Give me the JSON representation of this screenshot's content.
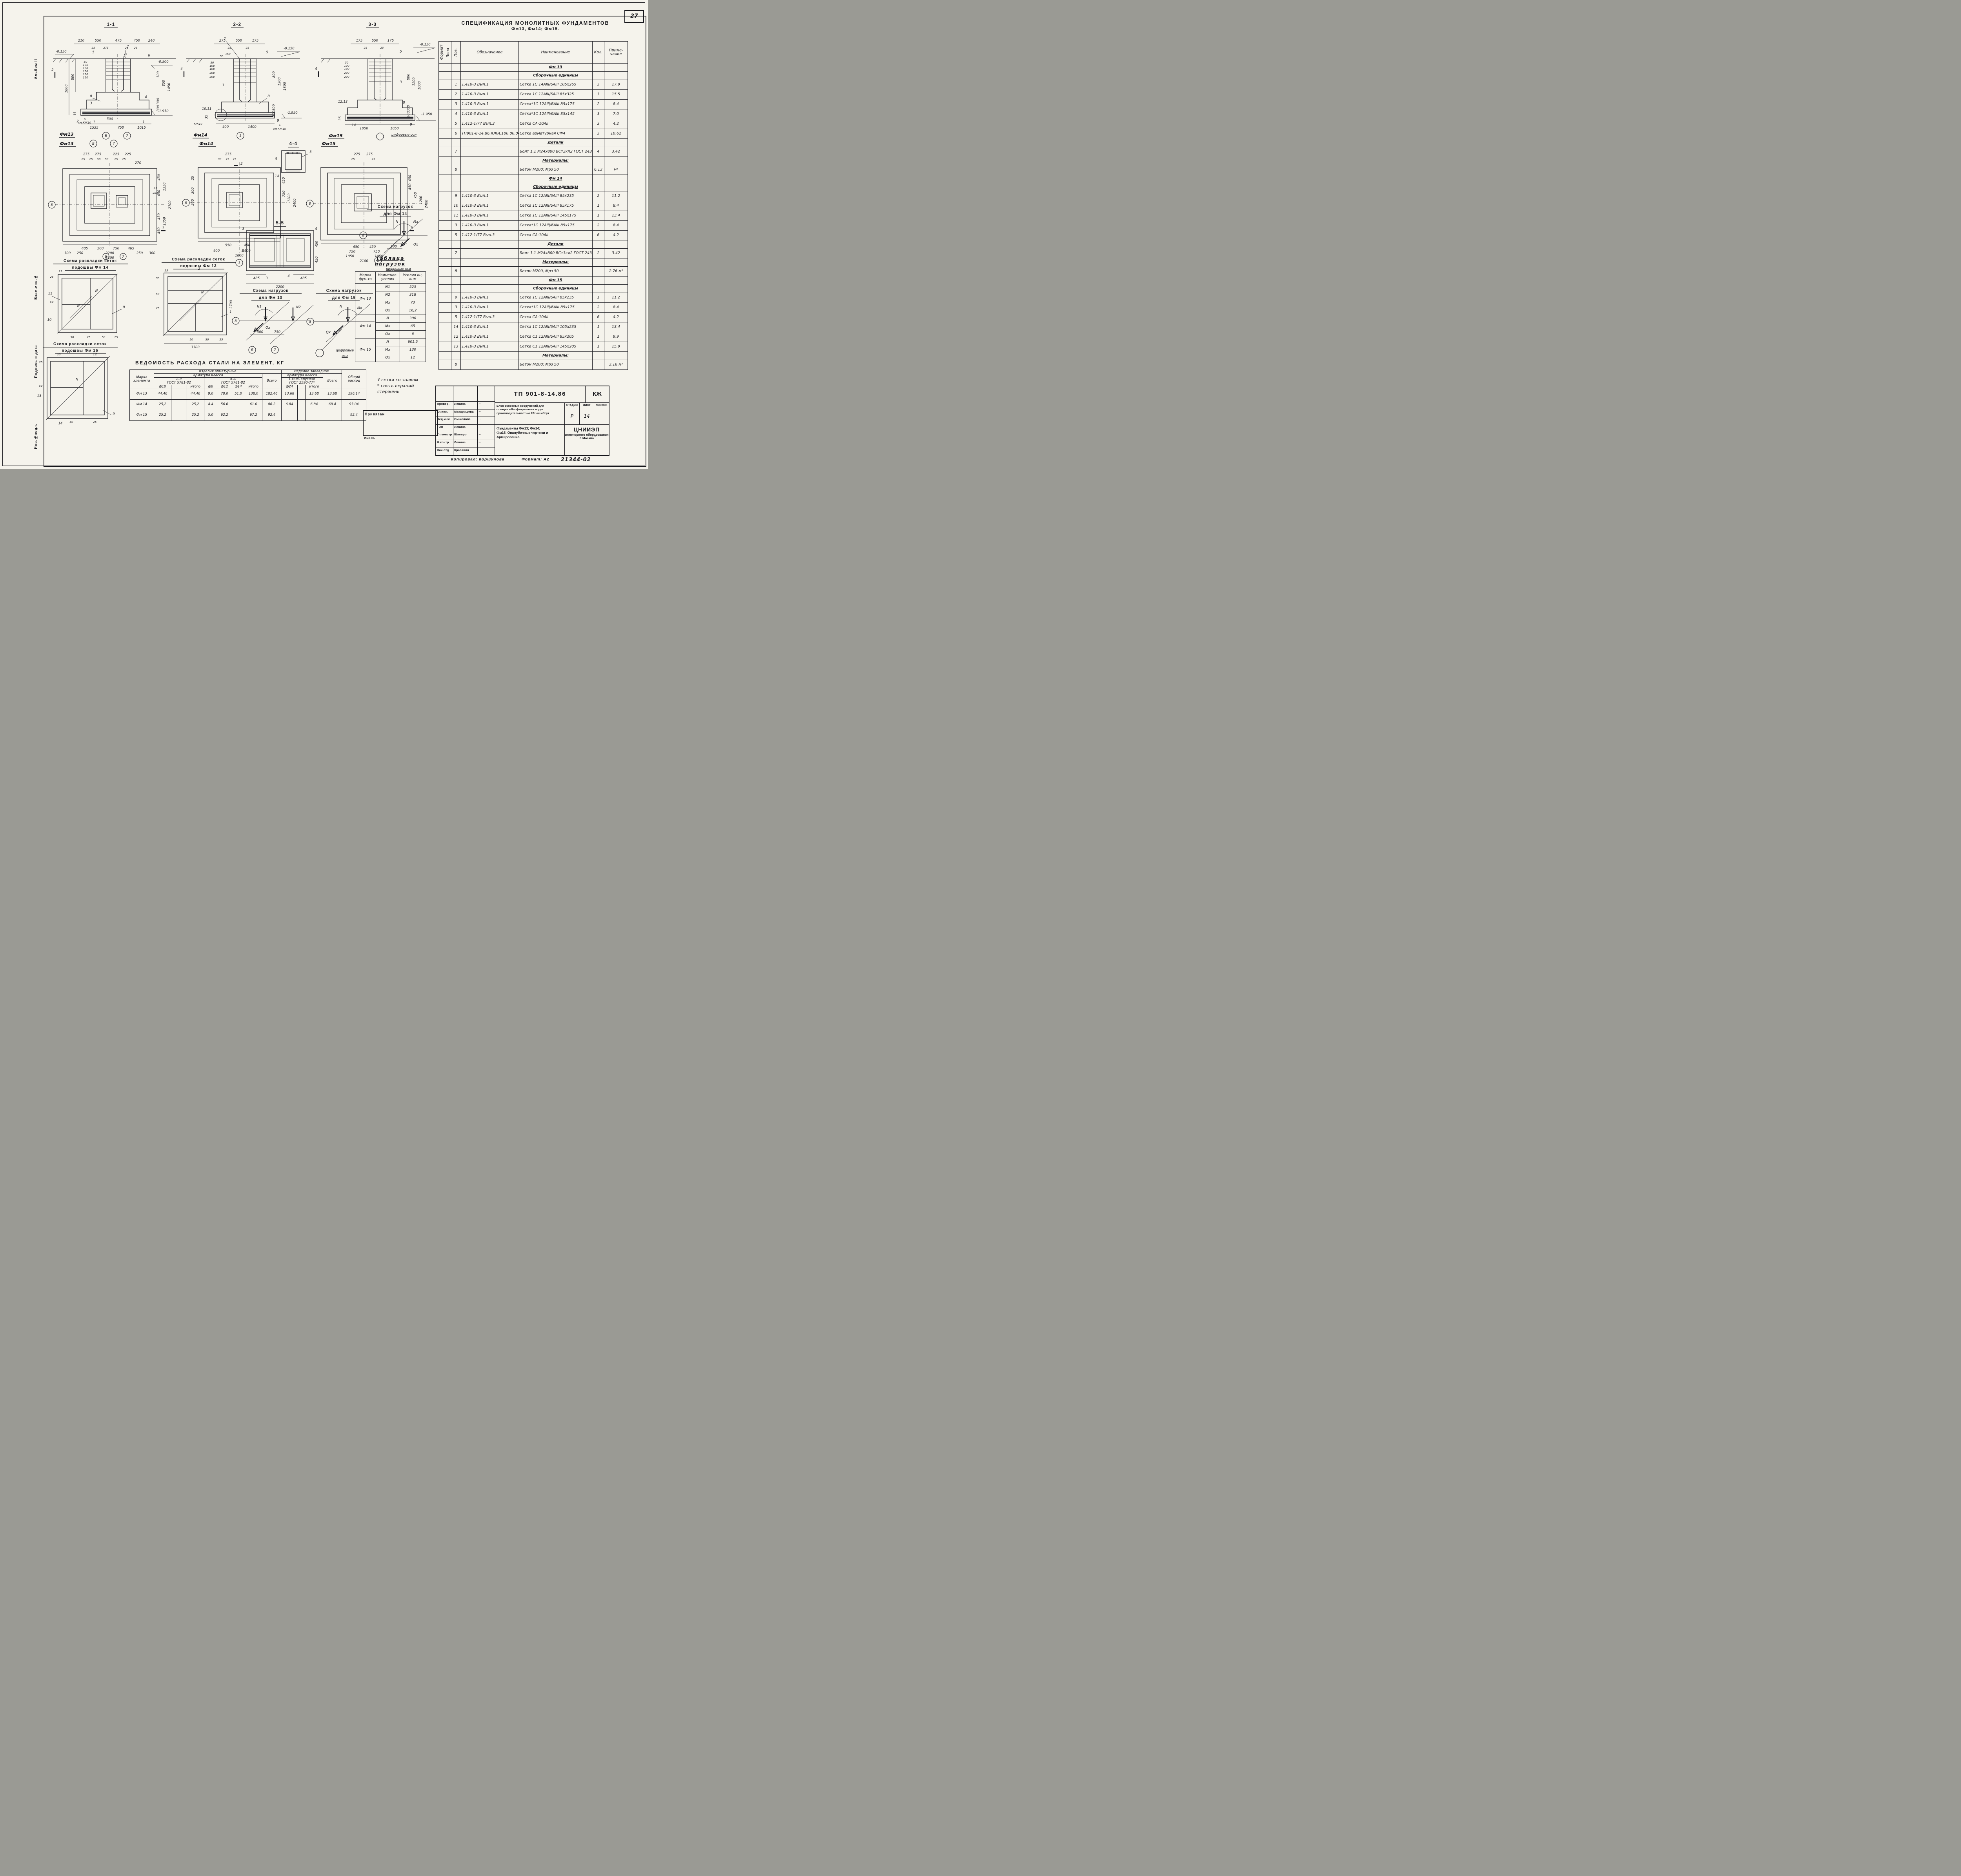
{
  "page": {
    "number": "27",
    "album_label": "Альбом II",
    "side_labels": [
      "Взам.инв.№",
      "Подпись и дата",
      "Инв.№подл."
    ],
    "copied_by": "Копировал: Коршунова",
    "format_label": "Формат: А2",
    "stamp_code": "21344-02",
    "binding_label": "Привязан",
    "inv_label": "Инв.№",
    "note_star_lines": [
      "У сетки со знаком",
      "* снять верхний",
      "стержень"
    ]
  },
  "spec": {
    "title1": "СПЕЦИФИКАЦИЯ МОНОЛИТНЫХ ФУНДАМЕНТОВ",
    "title2": "Фм13, Фм14; Фм15.",
    "headers": {
      "format": "Формат",
      "zone": "Зона",
      "pos": "Поз.",
      "designation": "Обозначение",
      "name": "Наименование",
      "qty": "Кол.",
      "note": "Приме- чание"
    },
    "rows": [
      {
        "g": true,
        "n": "Фм 13"
      },
      {
        "g": true,
        "n": "Сборочные единицы"
      },
      {
        "p": "1",
        "d": "1.410-3  Вып.1",
        "n": "Сетка 1С 14АIII/6АIII 105x265",
        "q": "3",
        "t": "17.9"
      },
      {
        "p": "2",
        "d": "1.410-3  Вып.1",
        "n": "Сетка 1С 12АIII/6АIII 85x325",
        "q": "3",
        "t": "15.5"
      },
      {
        "p": "3",
        "d": "1.410-3  Вып.1",
        "n": "Сетка*1С 12АIII/6АIII 85x175",
        "q": "2",
        "t": "8.4"
      },
      {
        "p": "4",
        "d": "1.410-3  Вып.1",
        "n": "Сетка*1С 12АIII/6АIII 85x145",
        "q": "3",
        "t": "7.0"
      },
      {
        "p": "5",
        "d": "1.412-1/77 Вып.3",
        "n": "Сетка СА-10АII",
        "q": "3",
        "t": "4.2"
      },
      {
        "p": "6",
        "d": "ТП901-8-14.86.КЖИ.100.00.04",
        "n": "Сетка арматурная СФ4",
        "q": "3",
        "t": "10.62"
      },
      {
        "g": true,
        "n": "Детали"
      },
      {
        "p": "7",
        "d": "",
        "n": "Болт 1.1 М24x800 ВСт3кп2 ГОСТ 24379.1-80",
        "q": "4",
        "t": "3.42"
      },
      {
        "g": true,
        "n": "Материалы:"
      },
      {
        "p": "8",
        "d": "",
        "n": "Бетон М200; Мрз 50",
        "q": "6.13",
        "t": "м³"
      },
      {
        "g": true,
        "n": "Фм 14"
      },
      {
        "g": true,
        "n": "Сборочные единицы"
      },
      {
        "p": "9",
        "d": "1.410-3  Вып.1",
        "n": "Сетка 1С 12АIII/6АIII 85x235",
        "q": "2",
        "t": "11.2"
      },
      {
        "p": "10",
        "d": "1.410-3  Вып.1",
        "n": "Сетка 1С 12АIII/6АIII 85x175",
        "q": "1",
        "t": "8.4"
      },
      {
        "p": "11",
        "d": "1.410-3  Вып.1",
        "n": "Сетка 1С 12АIII/6АIII 145x175",
        "q": "1",
        "t": "13.4"
      },
      {
        "p": "3",
        "d": "1.410-3  Вып.1",
        "n": "Сетка*1С 12АIII/6АIII 85x175",
        "q": "2",
        "t": "8.4"
      },
      {
        "p": "5",
        "d": "1.412-1/77 Вып.3",
        "n": "Сетка СА-10АII",
        "q": "6",
        "t": "4.2"
      },
      {
        "g": true,
        "n": "Детали"
      },
      {
        "p": "7",
        "d": "",
        "n": "Болт 1.1 М24x800 ВСт3кл2 ГОСТ 24379.1-80",
        "q": "2",
        "t": "3.42"
      },
      {
        "g": true,
        "n": "Материалы:"
      },
      {
        "p": "8",
        "d": "",
        "n": "Бетон М200, Мрз 50",
        "q": "",
        "t": "2.76 м³"
      },
      {
        "g": true,
        "n": "Фм 15"
      },
      {
        "g": true,
        "n": "Сборочные единицы"
      },
      {
        "p": "9",
        "d": "1.410-3  Вып.1",
        "n": "Сетка 1С 12АIII/6АIII 85x235",
        "q": "1",
        "t": "11.2"
      },
      {
        "p": "3",
        "d": "1.410-3  Вып.1",
        "n": "Сетка*1С 12АIII/6АIII 85x175",
        "q": "2",
        "t": "8.4"
      },
      {
        "p": "5",
        "d": "1.412-1/77 Вып.3",
        "n": "Сетка СА-10АII",
        "q": "6",
        "t": "4.2"
      },
      {
        "p": "14",
        "d": "1.410-3  Вып.1",
        "n": "Сетка 1С 12АIII/6АIII 105x235",
        "q": "1",
        "t": "13.4"
      },
      {
        "p": "12",
        "d": "1.410-3  Вып.1",
        "n": "Сетка С1 12АIII/6АIII 85x205",
        "q": "1",
        "t": "9.9"
      },
      {
        "p": "13",
        "d": "1.410-3  Вып.1",
        "n": "Сетка С1 12АIII/6АIII 145x205",
        "q": "1",
        "t": "15.9"
      },
      {
        "g": true,
        "n": "Материалы:"
      },
      {
        "p": "8",
        "d": "",
        "n": "Бетон М200; Мрз 50",
        "q": "",
        "t": "3.16 м³"
      }
    ]
  },
  "loads": {
    "title1": "Таблица",
    "title2": "нагрузок",
    "headers": [
      "Марка фун-та",
      "Наименов. усилия",
      "Усилия кн, кнм"
    ],
    "groups": [
      {
        "mark": "Фм 13",
        "rows": [
          [
            "N1",
            "523"
          ],
          [
            "N2",
            "318"
          ],
          [
            "Mx",
            "73"
          ],
          [
            "Qx",
            "16,2"
          ]
        ]
      },
      {
        "mark": "Фм 14",
        "rows": [
          [
            "N",
            "300"
          ],
          [
            "Mx",
            "65"
          ],
          [
            "Qx",
            "6"
          ]
        ]
      },
      {
        "mark": "Фм 15",
        "rows": [
          [
            "N",
            "601.5"
          ],
          [
            "Mx",
            "130"
          ],
          [
            "Qx",
            "12"
          ]
        ]
      }
    ]
  },
  "steel": {
    "title": "ВЕДОМОСТЬ РАСХОДА СТАЛИ НА ЭЛЕМЕНТ, КГ",
    "headers": {
      "mark": "Марка элемента",
      "prod": "Изделия арматурные",
      "emb": "Изделие закладное",
      "cls": "Арматура класса",
      "a2": "А-II",
      "a3": "А-III",
      "gost": "ГОСТ 5781-82",
      "round1": "Сталь круглая",
      "round2": "ГОСТ 2590-77*",
      "total": "Всего",
      "overall": "Общий расход",
      "f10": "ф10",
      "f6": "ф6",
      "f12": "ф12",
      "f14": "ф14",
      "f24": "ф24",
      "itogo": "итого"
    },
    "rows": [
      {
        "m": "Фм 13",
        "c": [
          "44.46",
          "",
          "",
          "44.46",
          "9.0",
          "78.0",
          "51.0",
          "138.0",
          "182.46",
          "13.68",
          "",
          "13.68",
          "13.68",
          "196.14"
        ]
      },
      {
        "m": "Фм 14",
        "c": [
          "25,2",
          "",
          "",
          "25,2",
          "4.4",
          "56.6",
          "",
          "61.0",
          "86.2",
          "6.84",
          "",
          "6.84",
          "68.4",
          "93.04"
        ]
      },
      {
        "m": "Фм 15",
        "c": [
          "25,2",
          "",
          "",
          "25,2",
          "5,0",
          "62,2",
          "",
          "67,2",
          "92.4",
          "",
          "",
          "",
          "",
          "92.4"
        ]
      }
    ]
  },
  "titleblock": {
    "code": "ТП 901-8-14.86",
    "kzh": "КЖ",
    "people": [
      {
        "r": "Провер.",
        "n": "Левина"
      },
      {
        "r": "Ст.инж.",
        "n": "Макарищева"
      },
      {
        "r": "Вед.инж",
        "n": "Смыслова"
      },
      {
        "r": "ГИП",
        "n": "Левина"
      },
      {
        "r": "Гл.констр",
        "n": "Шапиро"
      },
      {
        "r": "Н.контр",
        "n": "Левина"
      },
      {
        "r": "Нач.отд",
        "n": "Красавин"
      }
    ],
    "project1": "Блок основных сооружений для",
    "project2": "станции обесфторивания воды",
    "project3": "производительностью 20тыс.м³/сут",
    "stage_h": [
      "СТАДИЯ",
      "ЛИСТ",
      "ЛИСТОВ"
    ],
    "stage_v": [
      "Р",
      "14",
      ""
    ],
    "sheetname1": "Фундаменты Фм13; Фм14;",
    "sheetname2": "Фм15. Опалубочные чертежи и",
    "sheetname3": "Армирование.",
    "org_big": "ЦНИИЭП",
    "org2": "инженерного оборудования",
    "org3": "г. Москва"
  },
  "views": {
    "s11": {
      "title": "1-1",
      "mark": "Фм13",
      "top": [
        "210",
        "550",
        "475",
        "450",
        "240"
      ],
      "top2": [
        "25",
        "275",
        "25",
        "25"
      ],
      "diag": "150",
      "elev1": "-0.150",
      "elev2": "-0.500",
      "elev3": "-1.950",
      "left": [
        "1800",
        "800"
      ],
      "steps": [
        "50",
        "100",
        "100",
        "150",
        "150",
        "150"
      ],
      "d35": "35",
      "right": [
        "500",
        "850",
        "1450",
        "300",
        "300"
      ],
      "bot": [
        "1535",
        "750",
        "1015"
      ],
      "bot2": "500",
      "c5": "5",
      "c7": "7",
      "c6": "6",
      "c8": "8",
      "c3": "3",
      "c2": "2",
      "c1a": "1",
      "c1b": "1",
      "c4": "4",
      "axes": [
        "Б",
        "7"
      ],
      "noteA": "Б",
      "noteB": "см.КЖ10",
      "cut": "5"
    },
    "s22": {
      "title": "2-2",
      "mark": "Фм14",
      "top": [
        "275",
        "550",
        "175"
      ],
      "top2": [
        "25",
        "25"
      ],
      "elev1": "-0.150",
      "elev3": "-1.950",
      "steps": [
        "50",
        "100",
        "100",
        "200",
        "200"
      ],
      "extra1": "150",
      "extra2": "50",
      "d35": "35",
      "right": [
        "800",
        "1200",
        "1800",
        "300",
        "300"
      ],
      "bot": [
        "400",
        "1400"
      ],
      "c7": "7",
      "c5": "5",
      "c3": "3",
      "c8": "8",
      "c9": "9",
      "c1011": "10,11",
      "noteK": "КЖ10",
      "noteA": "А",
      "noteB": "см.КЖ10",
      "axis": "1",
      "cut": "4"
    },
    "s33": {
      "title": "3-3",
      "mark": "Фм15",
      "top": [
        "175",
        "550",
        "175"
      ],
      "top2": [
        "25",
        "25"
      ],
      "elev1": "-0.150",
      "elev3": "-1.950",
      "steps": [
        "50",
        "100",
        "100",
        "200",
        "200"
      ],
      "d35": "35",
      "right": [
        "800",
        "1200",
        "1800",
        "300",
        "300"
      ],
      "bot": [
        "1050",
        "1050"
      ],
      "c5": "5",
      "c3": "3",
      "c8": "8",
      "c9": "9",
      "c1213": "12,13",
      "c14": "14",
      "note": "цифровые оси",
      "cut": "4"
    },
    "s44": {
      "title": "4-4",
      "c3": "3",
      "c5": "5",
      "c14": "14"
    },
    "s55": {
      "title": "5-5",
      "c3a": "3",
      "c4a": "4",
      "cb": "Б",
      "c4b": "4",
      "c3b": "3",
      "bot": [
        "485",
        "485"
      ],
      "bot2": "2200",
      "right": [
        "450",
        "450"
      ]
    },
    "p13": {
      "mark": "Фм13",
      "axes": [
        "Б",
        "7"
      ],
      "axis8": "8",
      "top": [
        "275",
        "275",
        "225",
        "225"
      ],
      "top2": [
        "25",
        "25",
        "50",
        "50",
        "25",
        "25"
      ],
      "d270": "270",
      "right": [
        "450",
        "450",
        "450",
        "450"
      ],
      "right2": [
        "1350",
        "1350"
      ],
      "right3": "2700",
      "right4": [
        "25",
        "225"
      ],
      "bot": [
        "485",
        "500",
        "750",
        "465"
      ],
      "bot2": [
        "300",
        "250",
        "2200",
        "250",
        "300"
      ],
      "bot3": "3300",
      "cut": "1"
    },
    "p14": {
      "mark": "Фм14",
      "axis8": "8",
      "axis1": "1",
      "top": "275",
      "top2": [
        "90",
        "25",
        "25"
      ],
      "left": [
        "25",
        "300",
        "200"
      ],
      "right": [
        "450",
        "750",
        "1200"
      ],
      "right2": "2400",
      "bot": [
        "550",
        "450"
      ],
      "bot2": [
        "400",
        "1400"
      ],
      "bot3": "1800",
      "cut": "2"
    },
    "p15": {
      "mark": "Фм15",
      "axis8": "8",
      "top": [
        "275",
        "275"
      ],
      "top2": [
        "25",
        "25"
      ],
      "right": [
        "450",
        "450",
        "750",
        "1200"
      ],
      "right2": "2400",
      "bot": [
        "450",
        "450"
      ],
      "bot2": [
        "750",
        "750"
      ],
      "bot3": [
        "1050",
        "1050"
      ],
      "bot4": "2100",
      "cut": "3"
    },
    "r14": {
      "t1": "Схема раскладки сеток",
      "t2": "подошвы Фм 14",
      "axes": [
        "6",
        "7"
      ],
      "c11": "11",
      "c10": "10",
      "c9": "9",
      "n": "N",
      "dims": [
        "25",
        "25",
        "50",
        "50",
        "25",
        "50",
        "25"
      ]
    },
    "r13": {
      "t1": "Схема раскладки сеток",
      "t2": "подошвы Фм 13",
      "c2": "2",
      "c1": "1",
      "n": "N",
      "dims": [
        "25",
        "50",
        "50",
        "25",
        "50",
        "50",
        "25"
      ],
      "bot": "3300",
      "right": "2700"
    },
    "r15": {
      "t1": "Схема раскладки сеток",
      "t2": "подошвы Фм 15",
      "c12": "12",
      "c13": "13",
      "c14": "14",
      "c9": "9",
      "n": "N",
      "dims": [
        "25",
        "25",
        "50",
        "50",
        "25"
      ]
    },
    "n13": {
      "t1": "Схема нагрузок",
      "t2": "для Фм 13",
      "axes": [
        "8",
        "Б",
        "7"
      ],
      "lN1": "N1",
      "lN2": "N2",
      "lQ": "Qx",
      "dims": [
        "500",
        "750"
      ]
    },
    "n14": {
      "t1": "Схема нагрузок",
      "t2": "для Фм 14",
      "axes": [
        "8",
        "1"
      ],
      "lN": "N",
      "lM": "Mx",
      "lQ": "Qx",
      "dim": "500",
      "note": "цифровые оси"
    },
    "n15": {
      "t1": "Схема нагрузок",
      "t2": "для Фм 15",
      "axis": "8",
      "lN": "N",
      "lM": "Mx",
      "lQ": "Qx",
      "note1": "цифровые",
      "note2": "оси"
    }
  }
}
